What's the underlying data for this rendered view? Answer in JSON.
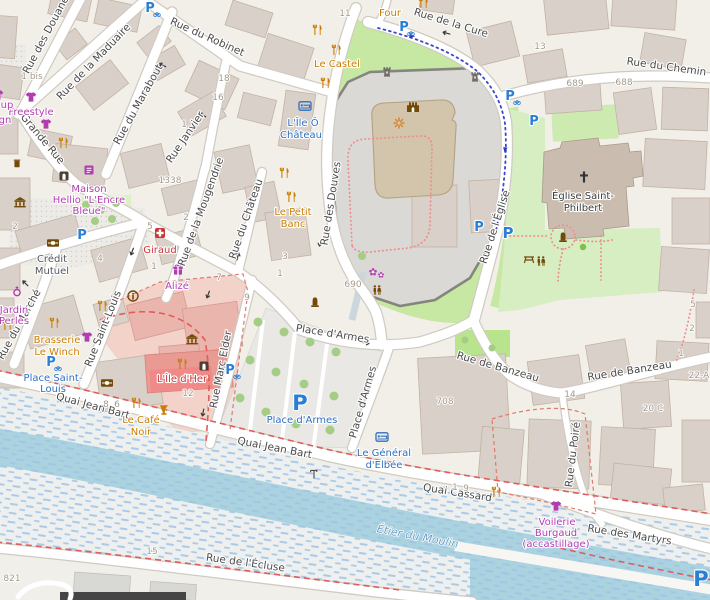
{
  "streets": {
    "douanes": "Rue des Douanes",
    "maduaire": "Rue de la Maduaire",
    "robinet": "Rue du Robinet",
    "grande_rue": "Grande Rue",
    "marabout": "Rue du Marabout",
    "janvier": "Rue Janvier",
    "mougendrie": "Rue de la Mougendrie",
    "chateau": "Rue du Château",
    "douves": "Rue des Douves",
    "cure": "Rue de la Cure",
    "chemin": "Rue du Chemin",
    "eglise": "Rue de l'Église",
    "marche": "Rue du Marché",
    "saint_louis": "Rue Saint-Louis",
    "marc_elder": "Rue Marc Elder",
    "place_d_armes": "Place d'Armes",
    "quai_jean_bart": "Quai Jean Bart",
    "quai_cassard": "Quai Cassard",
    "banzeau": "Rue de Banzeau",
    "poire": "Rue du Poiré",
    "martyrs": "Rue des Martyrs",
    "ecluse": "Rue de l'Écluse"
  },
  "water": {
    "etier_du_moulin": "Étier du Moulin"
  },
  "parking": {
    "letter": "P"
  },
  "pois": {
    "four": {
      "lines": [
        "Four"
      ]
    },
    "freestyle": {
      "lines": [
        "Freestyle"
      ]
    },
    "fragment_up": {
      "lines": [
        "up"
      ]
    },
    "fragment_gn": {
      "lines": [
        "gn"
      ]
    },
    "maison_hellio": {
      "lines": [
        "Maison",
        "Hellio \"L'Encre",
        "Bleue\""
      ]
    },
    "credit_mutuel": {
      "lines": [
        "Crédit",
        "Mutuel"
      ]
    },
    "giraud": {
      "lines": [
        "Giraud"
      ]
    },
    "alize": {
      "lines": [
        "Alizé"
      ]
    },
    "jardin_perles": {
      "lines": [
        "Jardin",
        "Perles"
      ]
    },
    "brasserie_le_winch": {
      "lines": [
        "Brasserie",
        "Le Winch"
      ]
    },
    "place_saint_louis": {
      "lines": [
        "Place Saint-",
        "Louis"
      ]
    },
    "le_castel": {
      "lines": [
        "Le Castel"
      ]
    },
    "l_ile_o_chateau": {
      "lines": [
        "L'Île Ô",
        "Château"
      ]
    },
    "le_petit_banc": {
      "lines": [
        "Le Petit",
        "Banc"
      ]
    },
    "l_ile_d_her": {
      "lines": [
        "L'Île d'Her"
      ]
    },
    "le_cafe_noir": {
      "lines": [
        "Le Café",
        "Noir"
      ]
    },
    "le_general_d_elbee": {
      "lines": [
        "Le Général",
        "d'Elbée"
      ]
    },
    "eglise_saint_philbert": {
      "lines": [
        "Église Saint-",
        "Philbert"
      ]
    },
    "voilerie_burgaud": {
      "lines": [
        "Voilerie",
        "Burgaud",
        "(accastillage)"
      ]
    },
    "place_d_armes_parking": {
      "lines": [
        "Place d'Armes"
      ]
    }
  },
  "housenumbers": {
    "n1": "1",
    "n1bis": "1 bis",
    "n2": "2",
    "n3": "3",
    "n4": "4",
    "n5": "5",
    "n6": "6",
    "n7": "7",
    "n8": "8",
    "n9": "9",
    "n11": "11",
    "n12": "12",
    "n13": "13",
    "n14": "14",
    "n15": "15",
    "n16": "16",
    "n18": "18",
    "n20c": "20 C",
    "n22a": "22-A",
    "n689": "689",
    "n688": "688",
    "n690": "690",
    "n708": "708",
    "n821": "821",
    "n1338": "1338"
  },
  "colors": {
    "land": "#f2efe9",
    "building": "#d9d0c9",
    "green": "#c6e8a2",
    "water": "#aad3df",
    "pink_zone": "#f3d2ca",
    "red_building": "#e99a92",
    "shop_label": "#b13db1",
    "food_label": "#c97d00",
    "parking_blue": "#2a7fd4",
    "tourism_blue": "#2e6fc0",
    "health_red": "#cc3434",
    "route_red": "#e25c5c"
  }
}
